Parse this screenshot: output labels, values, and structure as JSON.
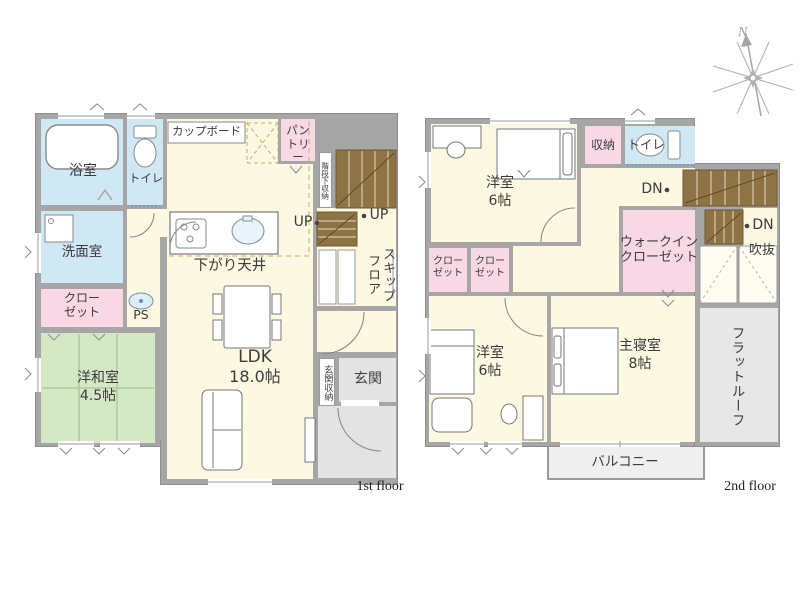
{
  "palette": {
    "wall_gray": "#a6a6a6",
    "room_cream": "#fdf8e1",
    "water_blue": "#cfe8f4",
    "closet_pink": "#f8d8e4",
    "tatami_green": "#d5e8c6",
    "service_gray": "#e3e3e3",
    "stair_brown": "#8e7344",
    "text": "#3b3b3b"
  },
  "compass": {
    "north": "N"
  },
  "floor1": {
    "caption": "1st floor",
    "bath": "浴室",
    "toilet": "トイレ",
    "washroom": "洗面室",
    "closet": "クローゼット",
    "jroom_name": "洋和室",
    "jroom_size": "4.5帖",
    "ps": "PS",
    "cupboard": "カップボード",
    "pantry": "パントリー",
    "lowered_ceiling": "下がり天井",
    "ldk_name": "LDK",
    "ldk_size": "18.0帖",
    "up_main": "UP",
    "up_skip": "UP",
    "under_stair_storage": "階段下収納",
    "skip_floor": "スキップフロア",
    "entrance_storage": "玄関収納",
    "entrance": "玄関"
  },
  "floor2": {
    "caption": "2nd floor",
    "bedroom_north_name": "洋室",
    "bedroom_north_size": "6帖",
    "storage": "収納",
    "toilet": "トイレ",
    "dn_main": "DN",
    "dn_skip": "DN",
    "void": "吹抜",
    "walk_in_closet": "ウォークインクローゼット",
    "closet_a": "クローゼット",
    "closet_b": "クローゼット",
    "bedroom_south_name": "洋室",
    "bedroom_south_size": "6帖",
    "master_name": "主寝室",
    "master_size": "8帖",
    "flat_roof": "フラットルーフ",
    "balcony": "バルコニー"
  }
}
